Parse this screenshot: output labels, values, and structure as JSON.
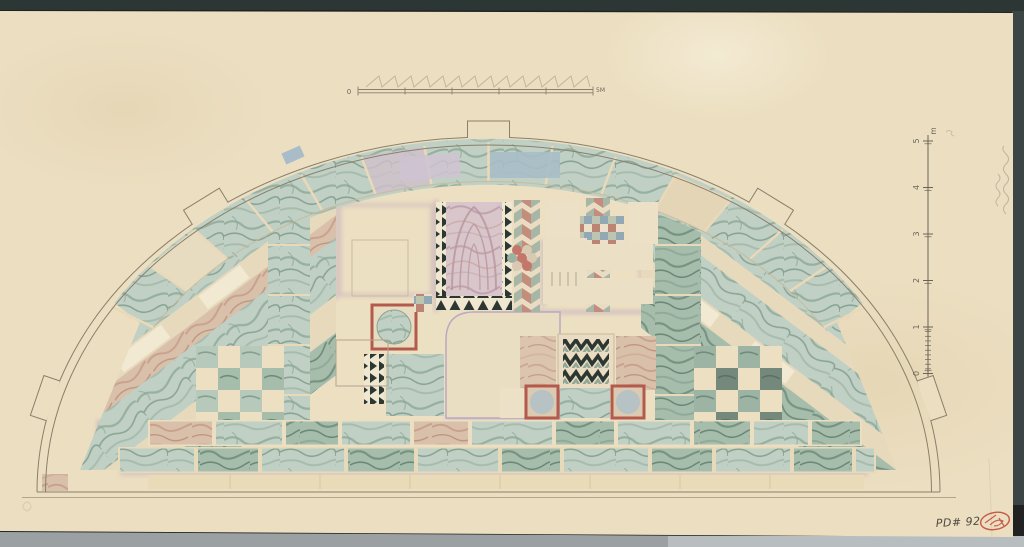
{
  "artifact": {
    "description": "Scanned watercolor drawing of a semicircular opus-sectile marble pavement plan on aged cream paper"
  },
  "scale_bar": {
    "zero_label": "0",
    "end_label": "5M",
    "segments": 5
  },
  "vertical_scale": {
    "unit_label": "m",
    "tick_labels": [
      "5",
      "4",
      "3",
      "2",
      "1",
      "0"
    ]
  },
  "inscriptions": {
    "catalog_number": "PD# 92"
  },
  "colors": {
    "paper": "#ecdfc1",
    "background_top": "#2c3634",
    "background_bottom": "#9ba1a3",
    "background_bottom_light": "#b8bdbf",
    "edge_strip": "#3d4446",
    "line_ink": "#8a7f6c",
    "pencil_grey": "#6a6458",
    "lavender_shadow": "#a48bb8",
    "green_marble": "#c0d0c4",
    "green_marble_dark": "#a7bdac",
    "pink_marble": "#d9c0ab",
    "purple_marble": "#d8c6ca",
    "blue_grey_tile": "#a9bcc8",
    "cream_tile": "#ece1c6",
    "accent_red": "#b35a4c",
    "stamp_red": "#c2493a",
    "chevron_black": "#2d3732"
  }
}
